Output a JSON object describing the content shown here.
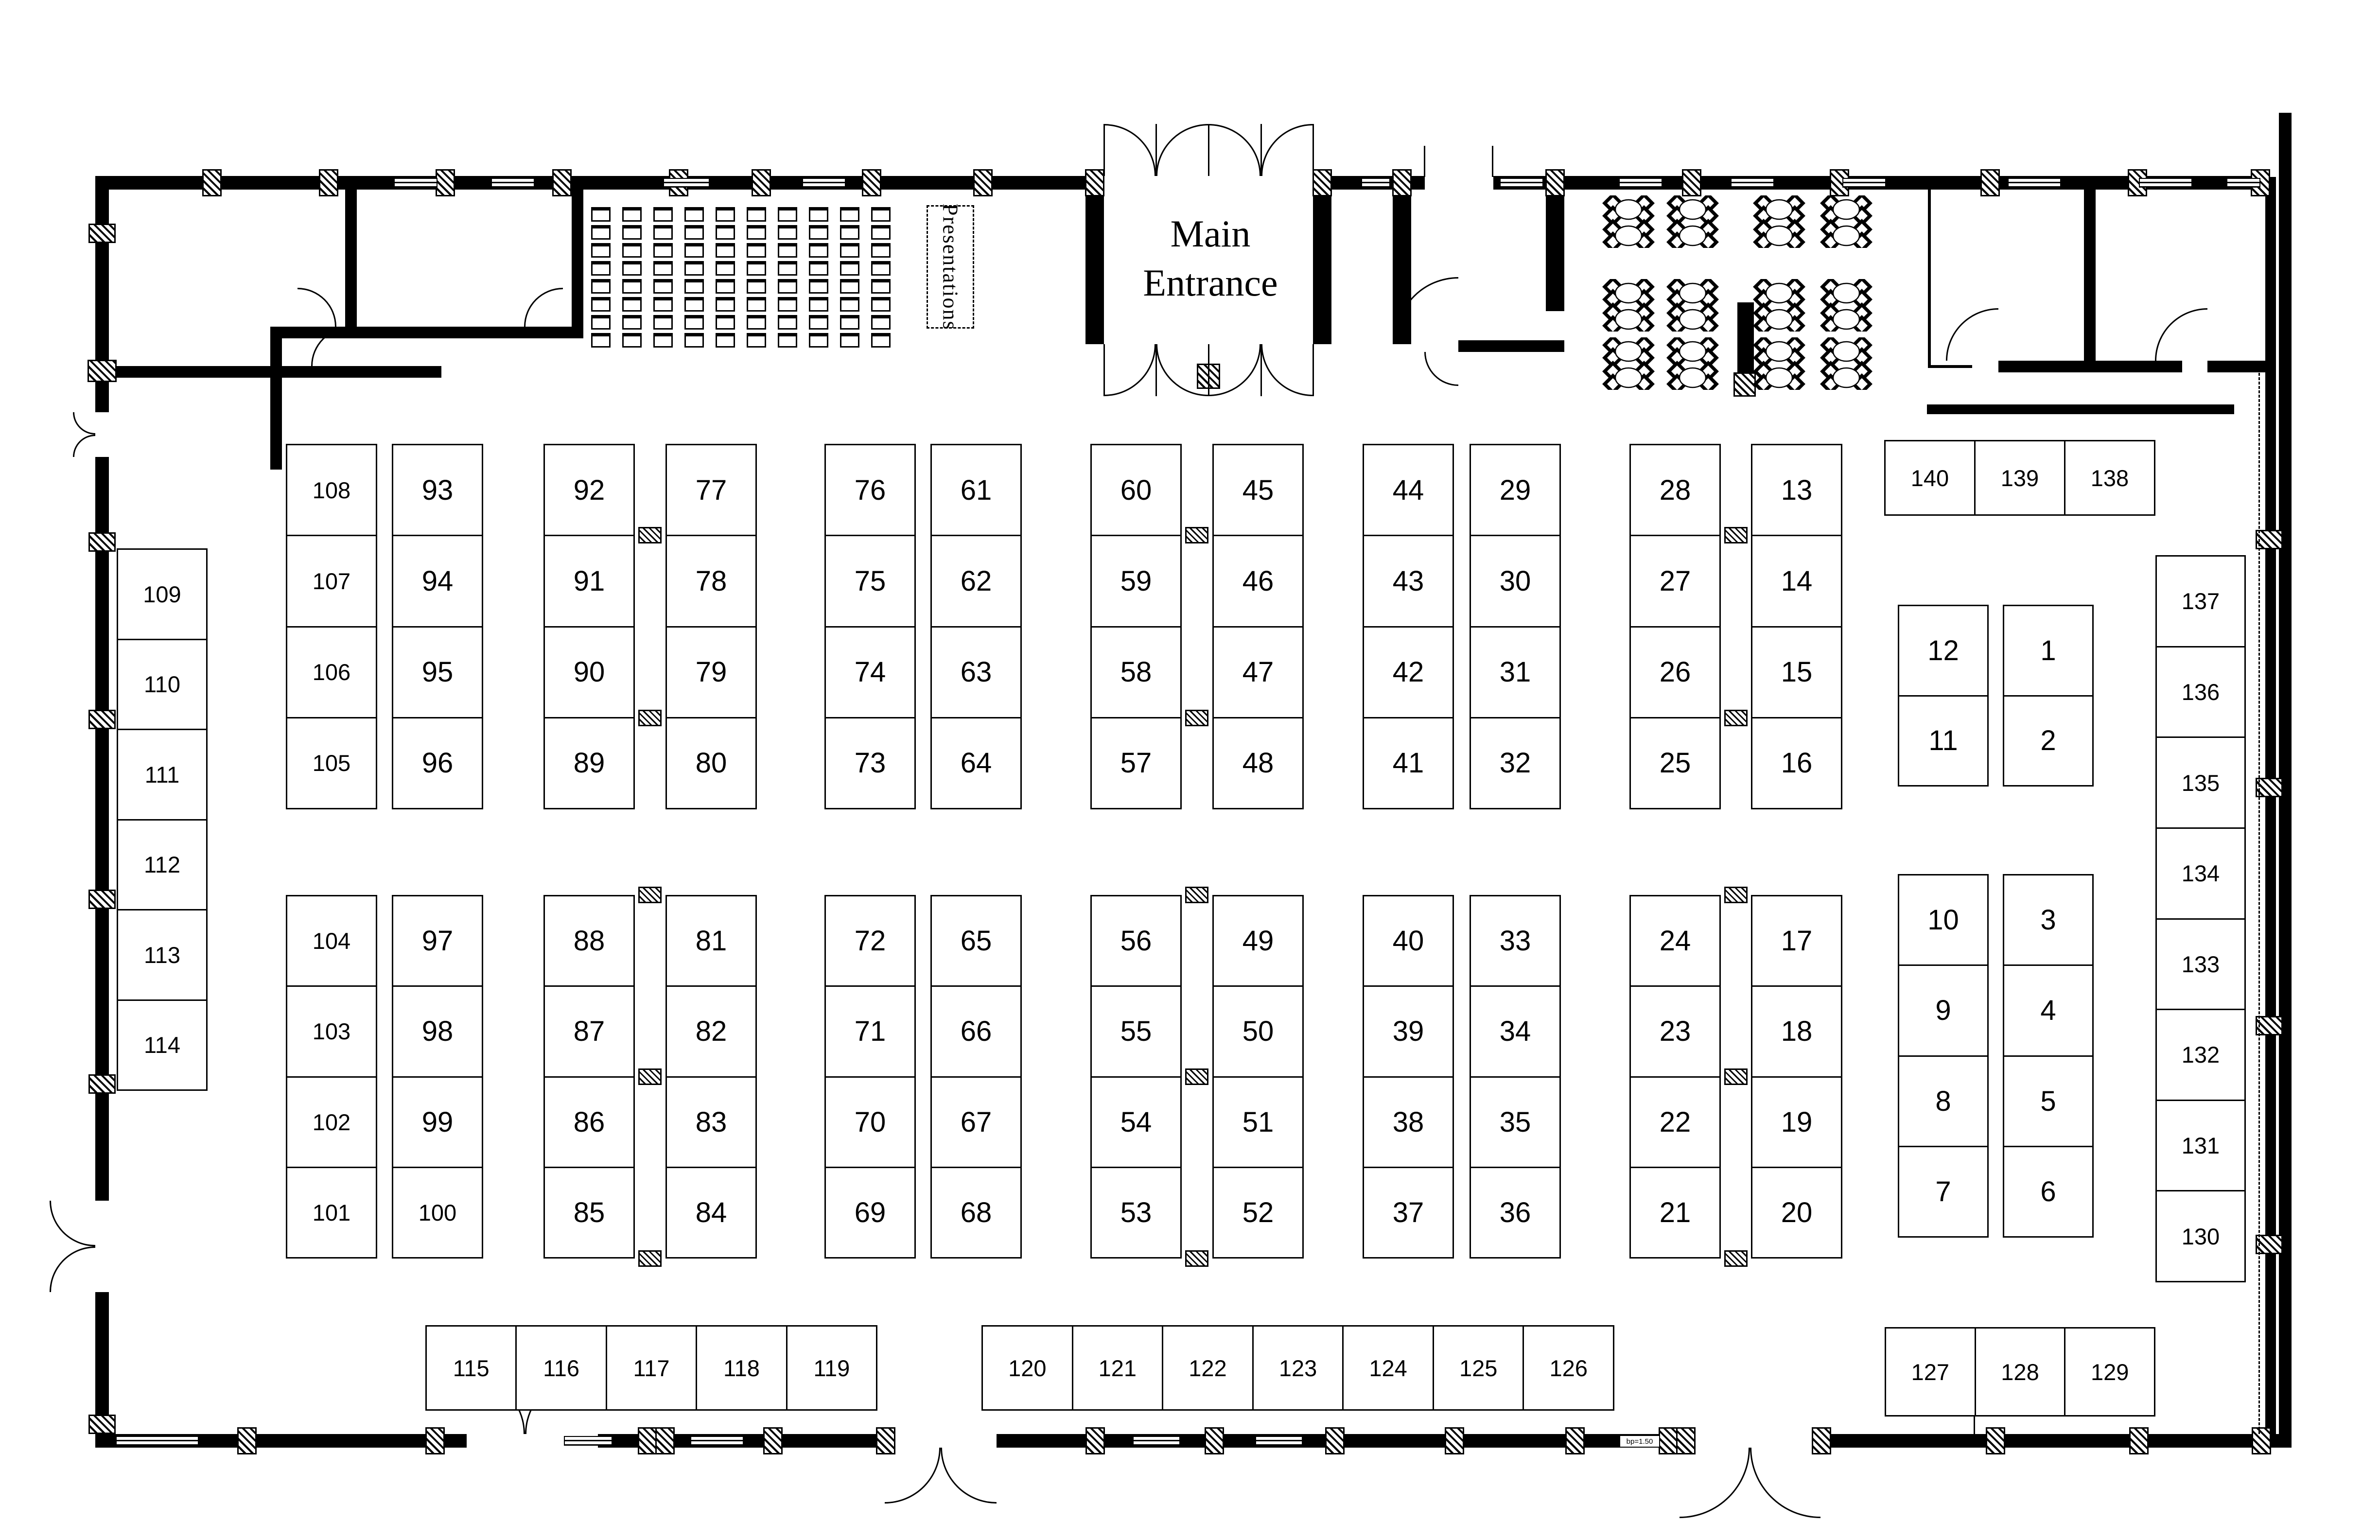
{
  "labels": {
    "main_entrance_line1": "Main",
    "main_entrance_line2": "Entrance",
    "presentations": "Presentations",
    "window_annotation": "bp=1.50"
  },
  "colors": {
    "ink": "#000000",
    "background": "#ffffff"
  },
  "booths": {
    "upper_blocks": [
      {
        "left": [
          "108",
          "107",
          "106",
          "105"
        ],
        "right": [
          "93",
          "94",
          "95",
          "96"
        ],
        "wide": false
      },
      {
        "left": [
          "92",
          "91",
          "90",
          "89"
        ],
        "right": [
          "77",
          "78",
          "79",
          "80"
        ],
        "wide": true
      },
      {
        "left": [
          "76",
          "75",
          "74",
          "73"
        ],
        "right": [
          "61",
          "62",
          "63",
          "64"
        ],
        "wide": false
      },
      {
        "left": [
          "60",
          "59",
          "58",
          "57"
        ],
        "right": [
          "45",
          "46",
          "47",
          "48"
        ],
        "wide": true
      },
      {
        "left": [
          "44",
          "43",
          "42",
          "41"
        ],
        "right": [
          "29",
          "30",
          "31",
          "32"
        ],
        "wide": false
      },
      {
        "left": [
          "28",
          "27",
          "26",
          "25"
        ],
        "right": [
          "13",
          "14",
          "15",
          "16"
        ],
        "wide": true
      }
    ],
    "lower_blocks": [
      {
        "left": [
          "104",
          "103",
          "102",
          "101"
        ],
        "right": [
          "97",
          "98",
          "99",
          "100"
        ],
        "wide": false
      },
      {
        "left": [
          "88",
          "87",
          "86",
          "85"
        ],
        "right": [
          "81",
          "82",
          "83",
          "84"
        ],
        "wide": true
      },
      {
        "left": [
          "72",
          "71",
          "70",
          "69"
        ],
        "right": [
          "65",
          "66",
          "67",
          "68"
        ],
        "wide": false
      },
      {
        "left": [
          "56",
          "55",
          "54",
          "53"
        ],
        "right": [
          "49",
          "50",
          "51",
          "52"
        ],
        "wide": true
      },
      {
        "left": [
          "40",
          "39",
          "38",
          "37"
        ],
        "right": [
          "33",
          "34",
          "35",
          "36"
        ],
        "wide": false
      },
      {
        "left": [
          "24",
          "23",
          "22",
          "21"
        ],
        "right": [
          "17",
          "18",
          "19",
          "20"
        ],
        "wide": true
      }
    ],
    "upper_small_blocks": [
      [
        "12",
        "11"
      ],
      [
        "1",
        "2"
      ]
    ],
    "lower_small_blocks": [
      [
        "10",
        "9",
        "8",
        "7"
      ],
      [
        "3",
        "4",
        "5",
        "6"
      ]
    ],
    "left_column": [
      "109",
      "110",
      "111",
      "112",
      "113",
      "114"
    ],
    "right_column": [
      "137",
      "136",
      "135",
      "134",
      "133",
      "132",
      "131",
      "130"
    ],
    "top_right_row": [
      "140",
      "139",
      "138"
    ],
    "bottom_left_row": [
      "115",
      "116",
      "117",
      "118",
      "119"
    ],
    "bottom_center_row": [
      "120",
      "121",
      "122",
      "123",
      "124",
      "125",
      "126"
    ],
    "bottom_right_row": [
      "127",
      "128",
      "129"
    ]
  }
}
